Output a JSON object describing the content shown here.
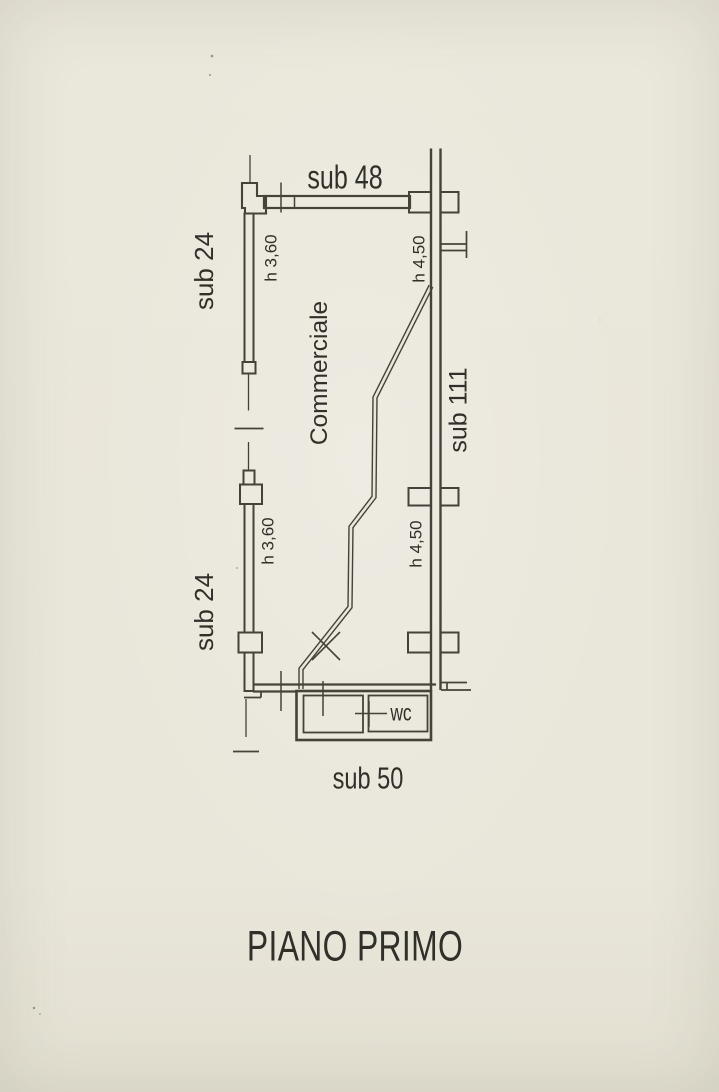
{
  "document": {
    "title": "PIANO PRIMO"
  },
  "colors": {
    "paper": "#e9e6da",
    "line": "#45423a",
    "text": "#302f2a"
  },
  "plan": {
    "room_label": "Commerciale",
    "wc_label": "wc",
    "subaltern_labels": {
      "top": "sub 48",
      "left_upper": "sub 24",
      "left_lower": "sub 24",
      "right": "sub 111",
      "bottom": "sub 50"
    },
    "height_labels": {
      "left_upper": "h 3,60",
      "left_lower": "h 3,60",
      "right_upper": "h 4,50",
      "right_lower": "h 4,50"
    }
  }
}
